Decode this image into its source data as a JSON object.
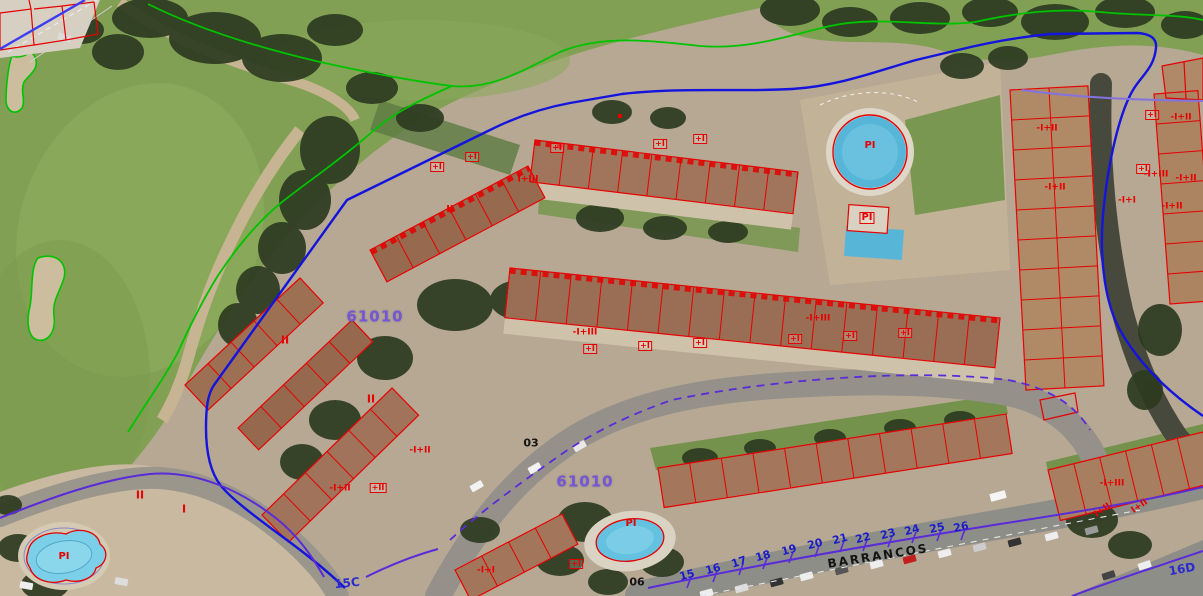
{
  "map": {
    "type": "cadastral-aerial-view",
    "parcel_codes": [
      "61010",
      "61010"
    ],
    "street": {
      "name": "BARRANCOS",
      "numbers": [
        "15",
        "16",
        "17",
        "18",
        "19",
        "20",
        "21",
        "22",
        "23",
        "24",
        "25",
        "26"
      ],
      "axis_codes": [
        "15C",
        "16D"
      ]
    },
    "road_point_labels": [
      "03",
      "06"
    ],
    "pool_label": "PI",
    "building_height_labels": [
      "I",
      "II",
      "I+II",
      "I+III",
      "+I",
      "+II",
      "-I+I",
      "-I+II",
      "-I+III"
    ],
    "colors": {
      "parcel_outline_red": "#e60000",
      "boundary_blue": "#1414dd",
      "street_axis_purple": "#5a2bd8",
      "golf_boundary_green": "#00c300",
      "parcel_code_text": "#7456d6",
      "street_number_text": "#1c1cc8",
      "street_name_text": "#141414"
    }
  },
  "labels": [
    {
      "t": "61010",
      "x": 375,
      "y": 317,
      "k": "code"
    },
    {
      "t": "61010",
      "x": 585,
      "y": 482,
      "k": "code"
    },
    {
      "t": "BARRANCOS",
      "x": 878,
      "y": 556,
      "k": "street",
      "r": -9
    },
    {
      "t": "15",
      "x": 687,
      "y": 575,
      "k": "num",
      "r": -15
    },
    {
      "t": "16",
      "x": 713,
      "y": 569,
      "k": "num",
      "r": -15
    },
    {
      "t": "17",
      "x": 739,
      "y": 562,
      "k": "num",
      "r": -18
    },
    {
      "t": "18",
      "x": 763,
      "y": 556,
      "k": "num",
      "r": -15
    },
    {
      "t": "19",
      "x": 789,
      "y": 550,
      "k": "num",
      "r": -15
    },
    {
      "t": "20",
      "x": 815,
      "y": 544,
      "k": "num",
      "r": -15
    },
    {
      "t": "21",
      "x": 840,
      "y": 539,
      "k": "num",
      "r": -15
    },
    {
      "t": "22",
      "x": 863,
      "y": 538,
      "k": "num",
      "r": -15
    },
    {
      "t": "23",
      "x": 888,
      "y": 534,
      "k": "num",
      "r": -15
    },
    {
      "t": "24",
      "x": 912,
      "y": 530,
      "k": "num",
      "r": -15
    },
    {
      "t": "25",
      "x": 937,
      "y": 528,
      "k": "num",
      "r": -12
    },
    {
      "t": "26",
      "x": 961,
      "y": 527,
      "k": "num",
      "r": -12
    },
    {
      "t": "15C",
      "x": 347,
      "y": 583,
      "k": "numc",
      "r": -6
    },
    {
      "t": "16D",
      "x": 1182,
      "y": 569,
      "k": "numc",
      "r": -10
    },
    {
      "t": "03",
      "x": 531,
      "y": 443,
      "k": "blk"
    },
    {
      "t": "06",
      "x": 637,
      "y": 582,
      "k": "blk"
    },
    {
      "t": "PI",
      "x": 870,
      "y": 146,
      "k": "red",
      "fs": 10
    },
    {
      "t": "PI",
      "x": 867,
      "y": 218,
      "k": "red",
      "fs": 10,
      "box": 1
    },
    {
      "t": "PI",
      "x": 631,
      "y": 524,
      "k": "red",
      "fs": 10
    },
    {
      "t": "PI",
      "x": 64,
      "y": 557,
      "k": "red",
      "fs": 10
    },
    {
      "t": "II",
      "x": 285,
      "y": 340,
      "k": "red",
      "fs": 11
    },
    {
      "t": "II",
      "x": 371,
      "y": 399,
      "k": "red",
      "fs": 11
    },
    {
      "t": "II",
      "x": 140,
      "y": 495,
      "k": "red",
      "fs": 11
    },
    {
      "t": "I",
      "x": 184,
      "y": 509,
      "k": "red",
      "fs": 11
    },
    {
      "t": "II",
      "x": 450,
      "y": 210,
      "k": "red",
      "fs": 10
    },
    {
      "t": "I+III",
      "x": 528,
      "y": 180,
      "k": "red"
    },
    {
      "t": "-I+III",
      "x": 585,
      "y": 333,
      "k": "red"
    },
    {
      "t": "-I+III",
      "x": 818,
      "y": 319,
      "k": "red"
    },
    {
      "t": "+I",
      "x": 590,
      "y": 349,
      "k": "red",
      "fs": 8,
      "box": 1
    },
    {
      "t": "+I",
      "x": 645,
      "y": 346,
      "k": "red",
      "fs": 8,
      "box": 1
    },
    {
      "t": "+I",
      "x": 700,
      "y": 343,
      "k": "red",
      "fs": 8,
      "box": 1
    },
    {
      "t": "+I",
      "x": 795,
      "y": 339,
      "k": "red",
      "fs": 8,
      "box": 1
    },
    {
      "t": "+I",
      "x": 850,
      "y": 336,
      "k": "red",
      "fs": 8,
      "box": 1
    },
    {
      "t": "+I",
      "x": 905,
      "y": 333,
      "k": "red",
      "fs": 8,
      "box": 1
    },
    {
      "t": "+I",
      "x": 437,
      "y": 167,
      "k": "red",
      "fs": 8,
      "box": 1
    },
    {
      "t": "+I",
      "x": 472,
      "y": 157,
      "k": "red",
      "fs": 8,
      "box": 1
    },
    {
      "t": "+I",
      "x": 557,
      "y": 148,
      "k": "red",
      "fs": 8,
      "box": 1
    },
    {
      "t": "+I",
      "x": 660,
      "y": 144,
      "k": "red",
      "fs": 8,
      "box": 1
    },
    {
      "t": "+I",
      "x": 700,
      "y": 139,
      "k": "red",
      "fs": 8,
      "box": 1
    },
    {
      "t": "-I+II",
      "x": 1047,
      "y": 129,
      "k": "red"
    },
    {
      "t": "-I+II",
      "x": 1055,
      "y": 188,
      "k": "red"
    },
    {
      "t": "+I",
      "x": 1152,
      "y": 115,
      "k": "red",
      "fs": 8,
      "box": 1
    },
    {
      "t": "-I+II",
      "x": 1181,
      "y": 118,
      "k": "red"
    },
    {
      "t": "+I",
      "x": 1143,
      "y": 169,
      "k": "red",
      "fs": 8,
      "box": 1
    },
    {
      "t": "-I+III",
      "x": 1156,
      "y": 175,
      "k": "red"
    },
    {
      "t": "-I+II",
      "x": 1186,
      "y": 179,
      "k": "red"
    },
    {
      "t": "-I+I",
      "x": 1127,
      "y": 201,
      "k": "red"
    },
    {
      "t": "-I+II",
      "x": 1172,
      "y": 207,
      "k": "red"
    },
    {
      "t": "-I+III",
      "x": 1112,
      "y": 484,
      "k": "red"
    },
    {
      "t": "I+II",
      "x": 1103,
      "y": 511,
      "k": "red",
      "r": -35
    },
    {
      "t": "I+II",
      "x": 1140,
      "y": 507,
      "k": "red",
      "r": -35
    },
    {
      "t": "-I+II",
      "x": 340,
      "y": 489,
      "k": "red"
    },
    {
      "t": "+II",
      "x": 378,
      "y": 488,
      "k": "red",
      "fs": 8,
      "box": 1
    },
    {
      "t": "-I+II",
      "x": 420,
      "y": 451,
      "k": "red"
    },
    {
      "t": "-I+I",
      "x": 486,
      "y": 571,
      "k": "red"
    },
    {
      "t": "+I",
      "x": 576,
      "y": 564,
      "k": "red",
      "fs": 8,
      "box": 1
    }
  ]
}
